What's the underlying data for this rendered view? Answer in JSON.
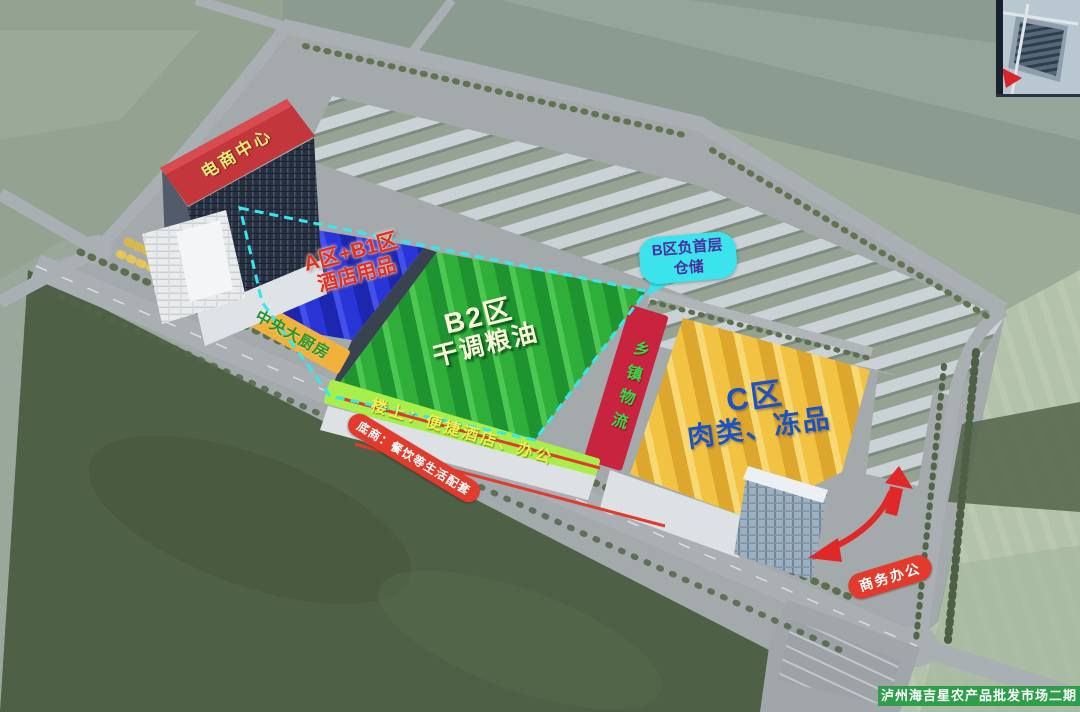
{
  "page": {
    "footer_banner": "泸州海吉星农产品批发市场二期",
    "footer_color": "#2f9e4b"
  },
  "tower": {
    "label": "电商中心",
    "band_color": "#c2363c",
    "label_color": "#e9ef7a"
  },
  "zones": {
    "a_b1": {
      "name": "A区+B1区",
      "category": "酒店用品",
      "fill": "#2a35d8",
      "label_color": "#df3020"
    },
    "b2": {
      "name": "B2区",
      "category": "干调粮油",
      "fill": "#2fae3a",
      "label_color": "#fcf9da"
    },
    "c": {
      "name": "C区",
      "category": "肉类、冻品",
      "fill": "#f3c344",
      "label_color": "#1c52c4"
    },
    "township_logistics": {
      "name": "乡镇物流",
      "fill": "#c9243f",
      "label_color": "#37d948"
    }
  },
  "callouts": {
    "basement": {
      "line1": "B区负首层",
      "line2": "仓储",
      "bubble_color": "#3be4ec",
      "label_color": "#4b2fa0"
    },
    "central_kitchen": {
      "label": "中央大厨房",
      "strip_color": "#f0b13d",
      "label_color": "#27962f"
    },
    "upstairs": {
      "label": "楼上：便捷酒店、办公",
      "strip_color": "#a8ef4b",
      "label_color": "#f8ec52"
    },
    "ground_floor": {
      "label": "底商：餐饮等生活配套",
      "bubble_color": "#e23a2c",
      "label_color": "#ffffff"
    },
    "business_office": {
      "label": "商务办公",
      "bubble_color": "#e23a2c",
      "label_color": "#ffffff"
    }
  },
  "outline": {
    "dash_color": "#35e8ee"
  },
  "minimap": {
    "pointer_color": "#d8252a"
  }
}
